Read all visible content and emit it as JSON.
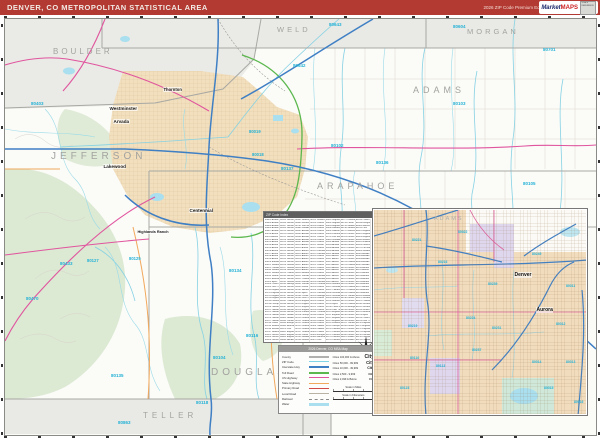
{
  "header": {
    "title": "DENVER, CO METROPOLITAN STATISTICAL AREA",
    "edition": "2026 ZIP Code Premium Edition",
    "logo": {
      "market": "Market",
      "maps": "MAPS",
      "badge": "SCALE REFERENCE"
    }
  },
  "colors": {
    "header_red": "#b23a32",
    "zip_cyan": "#25b2d6",
    "interstate_blue": "#3f7fc4",
    "us_highway_magenta": "#e0559e",
    "tollway_green": "#5cb84e",
    "state_highway_orange": "#f2a95c",
    "urban_tan": "#f2dfbd",
    "forest_green": "#dce9d3",
    "water_cyan": "#aadfef",
    "county_gray": "#a8a8a4"
  },
  "map": {
    "counties": [
      {
        "label": "BOULDER",
        "x": 48,
        "y": 28,
        "size": 8,
        "ls": 3
      },
      {
        "label": "WELD",
        "x": 272,
        "y": 6,
        "size": 7.5,
        "ls": 3
      },
      {
        "label": "MORGAN",
        "x": 462,
        "y": 8,
        "size": 7.5,
        "ls": 3
      },
      {
        "label": "JEFFERSON",
        "x": 46,
        "y": 132,
        "size": 10,
        "ls": 4
      },
      {
        "label": "ADAMS",
        "x": 408,
        "y": 66,
        "size": 9,
        "ls": 4
      },
      {
        "label": "ARAPAHOE",
        "x": 312,
        "y": 162,
        "size": 9,
        "ls": 4
      },
      {
        "label": "DOUGLAS",
        "x": 206,
        "y": 348,
        "size": 10,
        "ls": 4
      },
      {
        "label": "TELLER",
        "x": 138,
        "y": 392,
        "size": 8,
        "ls": 4
      }
    ],
    "cities": [
      {
        "label": "Westminster",
        "x": 104,
        "y": 87,
        "size": 4.6
      },
      {
        "label": "Thornton",
        "x": 158,
        "y": 68,
        "size": 4.2
      },
      {
        "label": "Arvada",
        "x": 108,
        "y": 100,
        "size": 4.6
      },
      {
        "label": "Lakewood",
        "x": 98,
        "y": 145,
        "size": 4.6
      },
      {
        "label": "Centennial",
        "x": 184,
        "y": 189,
        "size": 4.6
      },
      {
        "label": "Highlands Ranch",
        "x": 132,
        "y": 211,
        "size": 3.8
      }
    ],
    "zips": [
      {
        "label": "80643",
        "x": 324,
        "y": 3,
        "size": 4.5
      },
      {
        "label": "80604",
        "x": 448,
        "y": 5,
        "size": 4.5
      },
      {
        "label": "80642",
        "x": 288,
        "y": 44,
        "size": 4.5
      },
      {
        "label": "80701",
        "x": 538,
        "y": 28,
        "size": 4.5
      },
      {
        "label": "80103",
        "x": 448,
        "y": 82,
        "size": 4.5
      },
      {
        "label": "80102",
        "x": 326,
        "y": 124,
        "size": 4.5
      },
      {
        "label": "80136",
        "x": 371,
        "y": 141,
        "size": 4.5
      },
      {
        "label": "80137",
        "x": 276,
        "y": 147,
        "size": 4.5
      },
      {
        "label": "80105",
        "x": 518,
        "y": 162,
        "size": 4.5
      },
      {
        "label": "80019",
        "x": 244,
        "y": 110,
        "size": 4.2
      },
      {
        "label": "80018",
        "x": 247,
        "y": 133,
        "size": 4.2
      },
      {
        "label": "80403",
        "x": 26,
        "y": 82,
        "size": 4.5
      },
      {
        "label": "80433",
        "x": 55,
        "y": 242,
        "size": 4.5
      },
      {
        "label": "80470",
        "x": 21,
        "y": 277,
        "size": 4.5
      },
      {
        "label": "80127",
        "x": 82,
        "y": 239,
        "size": 4.2
      },
      {
        "label": "80125",
        "x": 124,
        "y": 237,
        "size": 4.2
      },
      {
        "label": "80134",
        "x": 224,
        "y": 249,
        "size": 4.5
      },
      {
        "label": "80135",
        "x": 106,
        "y": 354,
        "size": 4.5
      },
      {
        "label": "80104",
        "x": 208,
        "y": 336,
        "size": 4.5
      },
      {
        "label": "80116",
        "x": 241,
        "y": 314,
        "size": 4.5
      },
      {
        "label": "80118",
        "x": 191,
        "y": 381,
        "size": 4.5
      },
      {
        "label": "80863",
        "x": 113,
        "y": 401,
        "size": 4.5
      }
    ]
  },
  "zip_index": {
    "title": "ZIP Code Index",
    "entries": [
      "80002 Arvada",
      "80003 Arvada",
      "80004 Arvada",
      "80005 Arvada",
      "80007 Arvada",
      "80010 Aurora",
      "80011 Aurora",
      "80012 Aurora",
      "80013 Aurora",
      "80014 Aurora",
      "80015 Aurora",
      "80016 Aurora",
      "80017 Aurora",
      "80018 Aurora",
      "80019 Aurora",
      "80020 Broomfield",
      "80021 Westminster",
      "80022 Commerce City",
      "80030 Westminster",
      "80031 Westminster",
      "80033 Wheat Ridge",
      "80102 Bennett",
      "80103 Byers",
      "80104 Castle Rock",
      "80105 Deer Trail",
      "80110 Englewood",
      "80111 Englewood",
      "80112 Englewood",
      "80113 Englewood",
      "80116 Franktown",
      "80118 Larkspur",
      "80120 Littleton",
      "80121 Littleton",
      "80122 Littleton",
      "80123 Littleton",
      "80125 Littleton",
      "80127 Littleton",
      "80134 Parker",
      "80135 Sedalia",
      "80136 Strasburg",
      "80137 Watkins",
      "80202 Denver",
      "80203 Denver",
      "80204 Denver",
      "80205 Denver",
      "80206 Denver",
      "80207 Denver",
      "80209 Denver",
      "80210 Denver",
      "80211 Denver",
      "80212 Denver",
      "80214 Lakewood",
      "80215 Lakewood",
      "80216 Denver",
      "80219 Denver",
      "80220 Denver",
      "80221 Denver",
      "80222 Denver",
      "80223 Denver",
      "80224 Denver",
      "80226 Lakewood",
      "80227 Lakewood",
      "80228 Lakewood",
      "80229 Thornton",
      "80230 Denver",
      "80231 Denver",
      "80232 Lakewood",
      "80233 Northglenn",
      "80234 Denver",
      "80235 Denver",
      "80236 Denver",
      "80237 Denver",
      "80239 Denver",
      "80241 Thornton",
      "80246 Denver",
      "80247 Denver",
      "80249 Denver",
      "80260 Denver",
      "80401 Golden",
      "80403 Golden",
      "80433 Conifer",
      "80439 Evergreen",
      "80465 Morrison",
      "80470 Pine",
      "80601 Brighton",
      "80602 Brighton",
      "80603 Brighton",
      "80640 Henderson",
      "80642 Hudson",
      "80643 Keenesburg",
      "80701 Fort Morgan",
      "80863 Woodland Park"
    ]
  },
  "legend": {
    "title": "2026 Denver, CO MSA Map",
    "line_items": [
      {
        "label": "County",
        "color": "#b0b0ae",
        "w": 2.5
      },
      {
        "label": "ZIP Code",
        "color": "#7fd4e8",
        "w": 1.5
      },
      {
        "label": "Interstate Hwy",
        "color": "#3f7fc4",
        "w": 2
      },
      {
        "label": "Toll Road",
        "color": "#5cb84e",
        "w": 2
      },
      {
        "label": "US Highway",
        "color": "#e0559e",
        "w": 1.5
      },
      {
        "label": "State Highway",
        "color": "#f2a95c",
        "w": 1.5
      },
      {
        "label": "Primary Road",
        "color": "#d04a4a",
        "w": 1
      },
      {
        "label": "Local Road",
        "color": "#b9b3a6",
        "w": 1
      },
      {
        "label": "Railroad",
        "color": "#8a8a8a",
        "w": 1,
        "style": "dashed"
      },
      {
        "label": "Water",
        "color": "#aadfef",
        "fill": true
      }
    ],
    "city_sizes": [
      {
        "label": "Cities 100,000 & Above",
        "sample": "City",
        "sample_size": 5
      },
      {
        "label": "Cities 50,000 - 99,999",
        "sample": "City",
        "sample_size": 4.2
      },
      {
        "label": "Cities 10,000 - 49,999",
        "sample": "City",
        "sample_size": 3.6
      },
      {
        "label": "Cities 2,500 - 9,999",
        "sample": "City",
        "sample_size": 3
      },
      {
        "label": "Cities 2,499 & Below",
        "sample": "City",
        "sample_size": 2.6
      }
    ],
    "scales": [
      {
        "label": "Scale in Miles"
      },
      {
        "label": "Scale in Kilometers"
      }
    ]
  },
  "inset": {
    "county": {
      "label": "ADAMS",
      "x": 60,
      "y": 6,
      "size": 5.5
    },
    "cities": [
      {
        "label": "Denver",
        "x": 140,
        "y": 62,
        "size": 5
      },
      {
        "label": "Aurora",
        "x": 162,
        "y": 97,
        "size": 5
      }
    ],
    "zips": [
      {
        "label": "80221",
        "x": 38,
        "y": 28,
        "size": 3.4
      },
      {
        "label": "80022",
        "x": 84,
        "y": 20,
        "size": 3.4
      },
      {
        "label": "80216",
        "x": 64,
        "y": 50,
        "size": 3.4
      },
      {
        "label": "80239",
        "x": 114,
        "y": 72,
        "size": 3.4
      },
      {
        "label": "80249",
        "x": 158,
        "y": 42,
        "size": 3.4
      },
      {
        "label": "80011",
        "x": 192,
        "y": 74,
        "size": 3.4
      },
      {
        "label": "80219",
        "x": 34,
        "y": 114,
        "size": 3.4
      },
      {
        "label": "80224",
        "x": 92,
        "y": 106,
        "size": 3.4
      },
      {
        "label": "80231",
        "x": 118,
        "y": 116,
        "size": 3.4
      },
      {
        "label": "80237",
        "x": 98,
        "y": 138,
        "size": 3.4
      },
      {
        "label": "80012",
        "x": 182,
        "y": 112,
        "size": 3.4
      },
      {
        "label": "80014",
        "x": 158,
        "y": 150,
        "size": 3.4
      },
      {
        "label": "80015",
        "x": 170,
        "y": 176,
        "size": 3.4
      },
      {
        "label": "80013",
        "x": 192,
        "y": 150,
        "size": 3.4
      },
      {
        "label": "80113",
        "x": 62,
        "y": 154,
        "size": 3.4
      },
      {
        "label": "80110",
        "x": 36,
        "y": 146,
        "size": 3.4
      },
      {
        "label": "80123",
        "x": 26,
        "y": 176,
        "size": 3.4
      },
      {
        "label": "80016",
        "x": 200,
        "y": 190,
        "size": 3.4
      }
    ]
  }
}
